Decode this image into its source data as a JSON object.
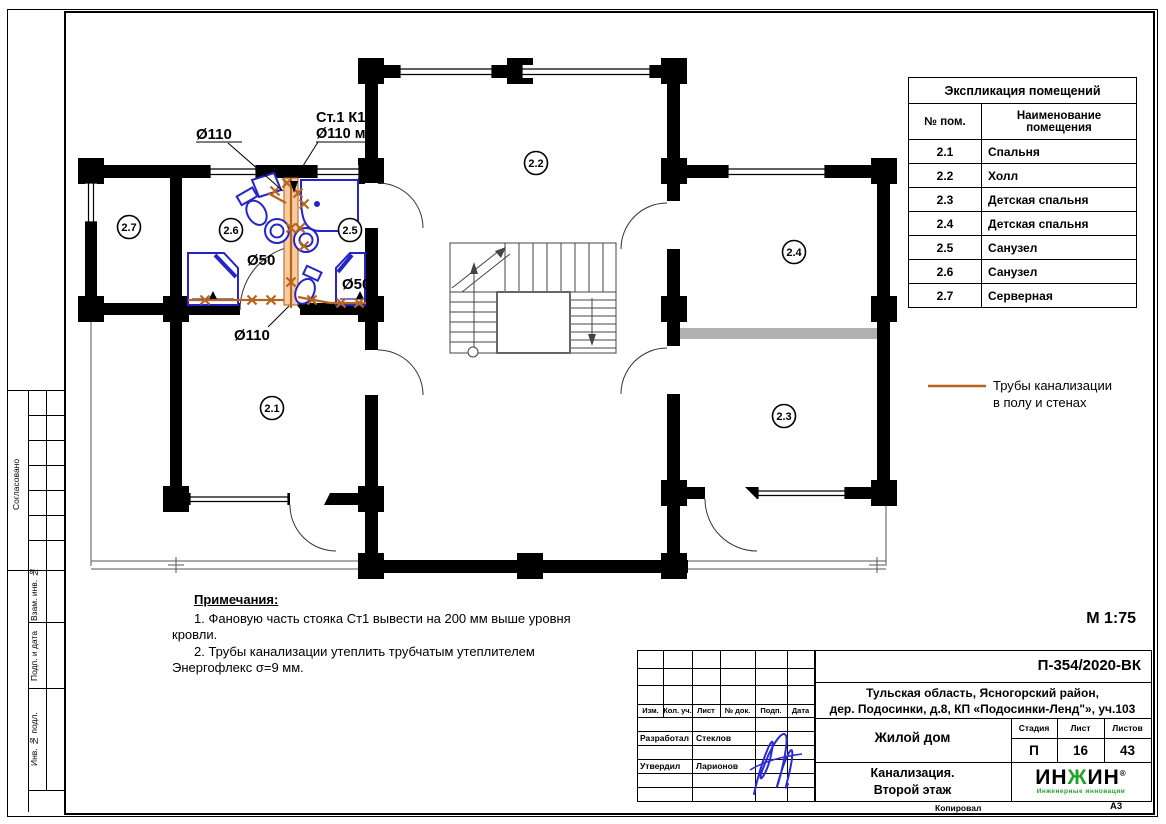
{
  "page": {
    "scale_label": "М 1:75",
    "copied_label": "Копировал",
    "format_label": "А3"
  },
  "side_strip": {
    "approved_label": "Согласовано",
    "vzam_label": "Взам. инв. №",
    "podp_label": "Подп. и дата",
    "inv_label": "Инв. № подл."
  },
  "room_table": {
    "title": "Экспликация помещений",
    "col_num": "№ пом.",
    "col_name": "Наименование помещения",
    "rows": [
      [
        "2.1",
        "Спальня"
      ],
      [
        "2.2",
        "Холл"
      ],
      [
        "2.3",
        "Детская спальня"
      ],
      [
        "2.4",
        "Детская спальня"
      ],
      [
        "2.5",
        "Санузел"
      ],
      [
        "2.6",
        "Санузел"
      ],
      [
        "2.7",
        "Серверная"
      ]
    ]
  },
  "plan": {
    "rooms": [
      "2.1",
      "2.2",
      "2.3",
      "2.4",
      "2.5",
      "2.6",
      "2.7"
    ],
    "labels": {
      "riser_line1": "Ст.1  К1",
      "riser_line2": "Ø110 мм",
      "d110_top": "Ø110",
      "d110_bottom": "Ø110",
      "d50_left": "Ø50",
      "d50_right": "Ø50"
    },
    "pipe_color": "#b5651d",
    "fixture_color": "#2424c8"
  },
  "legend": {
    "line1": "Трубы канализации",
    "line2": "в полу и стенах"
  },
  "notes": {
    "title": "Примечания:",
    "item1": "1.  Фановую часть стояка Ст1  вывести на 200 мм выше уровня кровли.",
    "item2": "2.  Трубы канализации утеплить трубчатым утеплителем Энергофлекс σ=9 мм."
  },
  "title_block": {
    "doc_number": "П-354/2020-ВК",
    "address_line1": "Тульская область, Ясногорский район,",
    "address_line2": "дер. Подосинки, д.8, КП «Подосинки-Ленд\"», уч.103",
    "object_name": "Жилой дом",
    "drawing_title_line1": "Канализация.",
    "drawing_title_line2": "Второй этаж",
    "stage_label": "Стадия",
    "sheet_label": "Лист",
    "sheets_label": "Листов",
    "stage_value": "П",
    "sheet_value": "16",
    "sheets_value": "43",
    "col_izm": "Изм.",
    "col_kol": "Кол. уч.",
    "col_list": "Лист",
    "col_dok": "№ док.",
    "col_podp": "Подп.",
    "col_data": "Дата",
    "role_developed": "Разработал",
    "name_developed": "Стеклов",
    "role_approved": "Утвердил",
    "name_approved": "Ларионов",
    "logo_text1": "ИН",
    "logo_text2": "Ж",
    "logo_text3": "ИН",
    "logo_reg": "®",
    "logo_tagline": "Инженерные инновации"
  }
}
